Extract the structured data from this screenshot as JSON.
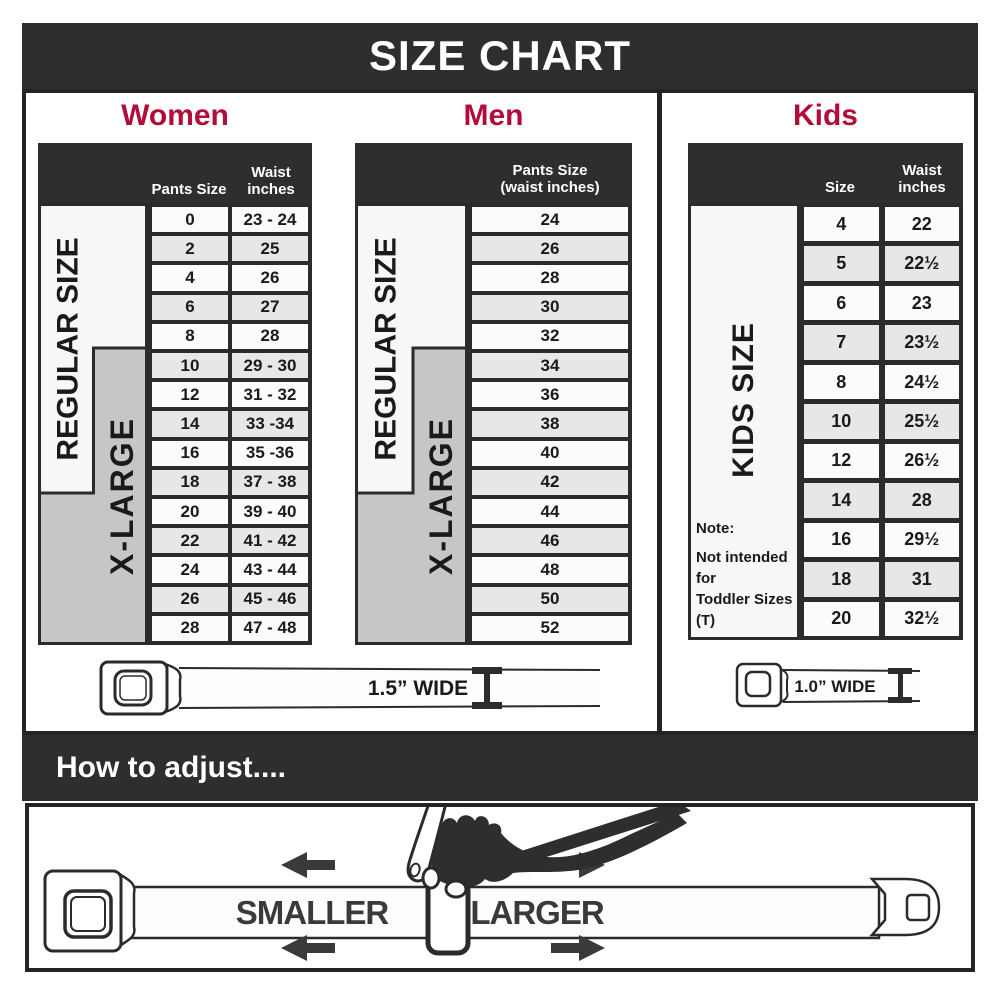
{
  "title": "SIZE CHART",
  "colors": {
    "banner_dark": "#2e2e2e",
    "heading_crimson": "#b20d38",
    "row_alt_gray": "#e7e7e7",
    "panel_gray": "#c6c6c6",
    "line_dark": "#2b2b2b",
    "arrow_gray": "#3a3a3a"
  },
  "sections": {
    "women": {
      "heading": "Women",
      "col1_header": "Pants Size",
      "col2_header_line1": "Waist",
      "col2_header_line2": "inches",
      "regular_label": "REGULAR SIZE",
      "xlarge_label": "X-LARGE",
      "rows": [
        {
          "size": "0",
          "waist": "23 - 24"
        },
        {
          "size": "2",
          "waist": "25"
        },
        {
          "size": "4",
          "waist": "26"
        },
        {
          "size": "6",
          "waist": "27"
        },
        {
          "size": "8",
          "waist": "28"
        },
        {
          "size": "10",
          "waist": "29 - 30"
        },
        {
          "size": "12",
          "waist": "31 - 32"
        },
        {
          "size": "14",
          "waist": "33 -34"
        },
        {
          "size": "16",
          "waist": "35 -36"
        },
        {
          "size": "18",
          "waist": "37 - 38"
        },
        {
          "size": "20",
          "waist": "39 - 40"
        },
        {
          "size": "22",
          "waist": "41 - 42"
        },
        {
          "size": "24",
          "waist": "43 - 44"
        },
        {
          "size": "26",
          "waist": "45 - 46"
        },
        {
          "size": "28",
          "waist": "47 - 48"
        }
      ]
    },
    "men": {
      "heading": "Men",
      "header_line1": "Pants Size",
      "header_line2": "(waist inches)",
      "regular_label": "REGULAR SIZE",
      "xlarge_label": "X-LARGE",
      "rows": [
        "24",
        "26",
        "28",
        "30",
        "32",
        "34",
        "36",
        "38",
        "40",
        "42",
        "44",
        "46",
        "48",
        "50",
        "52"
      ]
    },
    "kids": {
      "heading": "Kids",
      "col1_header": "Size",
      "col2_header_line1": "Waist",
      "col2_header_line2": "inches",
      "panel_label": "KIDS SIZE",
      "note_line1": "Note:",
      "note_line2": "Not intended for",
      "note_line3": "Toddler Sizes (T)",
      "rows": [
        {
          "size": "4",
          "waist": "22"
        },
        {
          "size": "5",
          "waist": "22½"
        },
        {
          "size": "6",
          "waist": "23"
        },
        {
          "size": "7",
          "waist": "23½"
        },
        {
          "size": "8",
          "waist": "24½"
        },
        {
          "size": "10",
          "waist": "25½"
        },
        {
          "size": "12",
          "waist": "26½"
        },
        {
          "size": "14",
          "waist": "28"
        },
        {
          "size": "16",
          "waist": "29½"
        },
        {
          "size": "18",
          "waist": "31"
        },
        {
          "size": "20",
          "waist": "32½"
        }
      ]
    }
  },
  "belts": {
    "adult_width_label": "1.5” WIDE",
    "kids_width_label": "1.0” WIDE"
  },
  "how_to_adjust": {
    "heading": "How to adjust....",
    "smaller_label": "SMALLER",
    "larger_label": "LARGER"
  }
}
